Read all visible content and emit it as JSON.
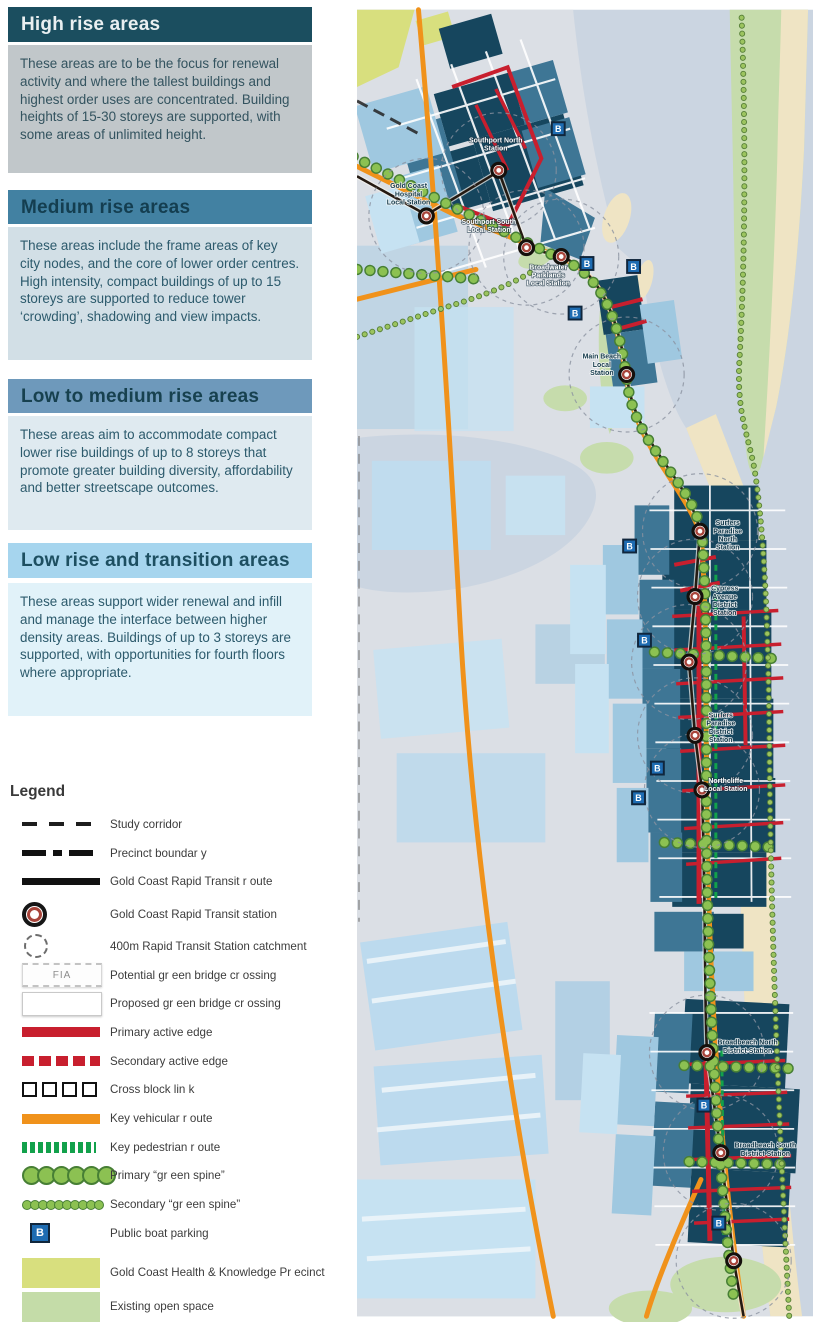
{
  "panels": [
    {
      "title": "High rise areas",
      "body": "These areas are to be the focus for renewal activity and where the tallest buildings and highest order uses are concentrated.  Building heights of 15-30 storeys are supported, with some areas of unlimited height."
    },
    {
      "title": "Medium rise areas",
      "body": "These areas include the frame areas of key city nodes, and the core of lower order centres.  High intensity, compact buildings of up to 15 storeys are supported to reduce tower ‘crowding’, shadowing and view impacts."
    },
    {
      "title": "Low to medium rise areas",
      "body": "These areas aim to accommodate compact lower rise buildings of up to 8 storeys that promote greater building diversity, affordability and better streetscape outcomes."
    },
    {
      "title": "Low rise and transition areas",
      "body": "These areas support wider renewal and infill and manage the interface between higher density areas.  Buildings of up to 3 storeys are supported, with opportunities for fourth floors where appropriate."
    }
  ],
  "legend": {
    "title": "Legend",
    "fia_text": "FIA",
    "items": [
      {
        "label": "Study corridor",
        "symbol": "study-corridor"
      },
      {
        "label": "Precinct boundar y",
        "symbol": "precinct-boundary"
      },
      {
        "label": "Gold Coast Rapid  Transit r oute",
        "symbol": "transit-route"
      },
      {
        "label": "Gold Coast Rapid  Transit station",
        "symbol": "transit-station"
      },
      {
        "label": "400m Rapid  Transit Station catchment",
        "symbol": "catchment"
      },
      {
        "label": "Potential gr een bridge cr ossing",
        "symbol": "potential-green-bridge"
      },
      {
        "label": "Proposed gr een bridge cr ossing",
        "symbol": "proposed-green-bridge"
      },
      {
        "label": "Primary active edge",
        "symbol": "primary-active-edge"
      },
      {
        "label": "Secondary active edge",
        "symbol": "secondary-active-edge"
      },
      {
        "label": "Cross block lin k",
        "symbol": "cross-block-link"
      },
      {
        "label": "Key vehicular r oute",
        "symbol": "key-vehicular-route"
      },
      {
        "label": "Key pedestrian r oute",
        "symbol": "key-pedestrian-route"
      },
      {
        "label": "Primary “gr een spine”",
        "symbol": "primary-green-spine"
      },
      {
        "label": "Secondary “gr een spine”",
        "symbol": "secondary-green-spine"
      },
      {
        "label": "Public boat parking",
        "symbol": "public-boat-parking"
      },
      {
        "label": "Gold Coast Health & Knowledge Pr ecinct",
        "symbol": "health-knowledge-precinct"
      },
      {
        "label": "Existing open space",
        "symbol": "existing-open-space"
      }
    ]
  },
  "map": {
    "boat_label": "B",
    "stations": [
      {
        "name": "Gold Coast Hospital Local Station",
        "lines": [
          "Gold Coast",
          "Hospital",
          "Local Station"
        ],
        "tone": "dark",
        "x": 70,
        "y": 208,
        "lx": 52,
        "ly": 180
      },
      {
        "name": "Southport North Station",
        "lines": [
          "Southport North",
          "Station"
        ],
        "tone": "light",
        "x": 143,
        "y": 162,
        "lx": 140,
        "ly": 134
      },
      {
        "name": "Southport South Local Station",
        "lines": [
          "Southport South",
          "Local Station"
        ],
        "tone": "light",
        "x": 171,
        "y": 240,
        "lx": 133,
        "ly": 216
      },
      {
        "name": "Broadwater Parklands Local Station",
        "lines": [
          "Broadwater",
          "Parklands",
          "Local Station"
        ],
        "tone": "light",
        "x": 206,
        "y": 249,
        "lx": 193,
        "ly": 262
      },
      {
        "name": "Main Beach Local Station",
        "lines": [
          "Main Beach",
          "Local",
          "Station"
        ],
        "tone": "dark",
        "x": 272,
        "y": 368,
        "lx": 247,
        "ly": 352
      },
      {
        "name": "Surfers Paradise North Station",
        "lines": [
          "Surfers",
          "Paradise",
          "North",
          "Station"
        ],
        "tone": "dark",
        "x": 346,
        "y": 526,
        "lx": 374,
        "ly": 520
      },
      {
        "name": "Cypress Avenue District Station",
        "lines": [
          "Cypress",
          "Avenue",
          "District",
          "Station"
        ],
        "tone": "dark",
        "x": 341,
        "y": 592,
        "lx": 371,
        "ly": 586
      },
      {
        "name": "",
        "lines": null,
        "tone": "dark",
        "x": 335,
        "y": 658,
        "lx": 0,
        "ly": 0
      },
      {
        "name": "Surfers Paradise District Station",
        "lines": [
          "Surfers",
          "Paradise",
          "District",
          "Station"
        ],
        "tone": "dark",
        "x": 341,
        "y": 732,
        "lx": 367,
        "ly": 714
      },
      {
        "name": "Northcliffe Local Station",
        "lines": [
          "Northcliffe",
          "Local Station"
        ],
        "tone": "light",
        "x": 348,
        "y": 787,
        "lx": 372,
        "ly": 780
      },
      {
        "name": "Broadbeach North District Station",
        "lines": [
          "Broadbeach North",
          "District Station"
        ],
        "tone": "dark",
        "x": 353,
        "y": 1052,
        "lx": 394,
        "ly": 1044
      },
      {
        "name": "Broadbeach South District Station",
        "lines": [
          "Broadbeach South",
          "District Station"
        ],
        "tone": "dark",
        "x": 367,
        "y": 1153,
        "lx": 412,
        "ly": 1148
      },
      {
        "name": "",
        "lines": null,
        "tone": "dark",
        "x": 380,
        "y": 1262,
        "lx": 0,
        "ly": 0
      }
    ],
    "boat_markers": [
      {
        "x": 203,
        "y": 120
      },
      {
        "x": 232,
        "y": 256
      },
      {
        "x": 279,
        "y": 259
      },
      {
        "x": 220,
        "y": 306
      },
      {
        "x": 275,
        "y": 541
      },
      {
        "x": 290,
        "y": 636
      },
      {
        "x": 303,
        "y": 765
      },
      {
        "x": 284,
        "y": 795
      },
      {
        "x": 350,
        "y": 1105
      },
      {
        "x": 365,
        "y": 1224
      }
    ],
    "colors": {
      "water": "#CBD5E1",
      "land": "#DBDFE5",
      "sand": "#EFE4C4",
      "high_rise_navy": "#16465E",
      "medium_blue": "#3E7695",
      "light_blue": "#9FC8E0",
      "pale_blue": "#C6E2F2",
      "open_space_green": "#C6DCAC",
      "precinct_yellow_green": "#D8DF7E",
      "vehicular_orange": "#F0921B",
      "active_edge_red": "#C81F2E",
      "pedestrian_green": "#12A14B",
      "green_spine": "#8CC152",
      "transit_line": "#241A12",
      "boat_blue": "#1E6CB2"
    }
  }
}
